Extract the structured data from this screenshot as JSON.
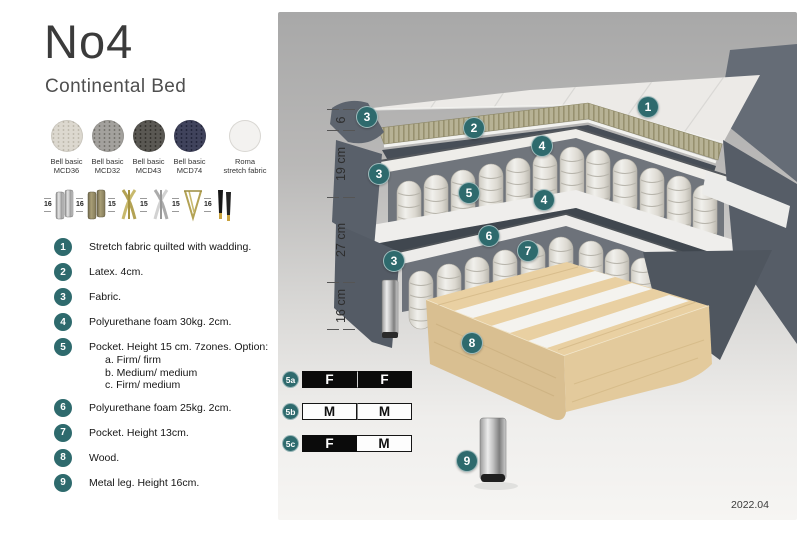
{
  "header": {
    "title": "No4",
    "subtitle": "Continental Bed"
  },
  "fabrics": [
    {
      "line1": "Bell basic",
      "line2": "MCD36"
    },
    {
      "line1": "Bell basic",
      "line2": "MCD32"
    },
    {
      "line1": "Bell basic",
      "line2": "MCD43"
    },
    {
      "line1": "Bell basic",
      "line2": "MCD74"
    },
    {
      "line1": "Roma",
      "line2": "stretch fabric"
    }
  ],
  "leg_options": [
    {
      "height": "16",
      "type": "cylinder-silver"
    },
    {
      "height": "16",
      "type": "cylinder-brass"
    },
    {
      "height": "15",
      "type": "cross-gold"
    },
    {
      "height": "15",
      "type": "cross-silver"
    },
    {
      "height": "15",
      "type": "hairpin-gold"
    },
    {
      "height": "16",
      "type": "tapered-black-gold"
    }
  ],
  "parts": [
    {
      "num": "1",
      "text": "Stretch fabric quilted with wadding."
    },
    {
      "num": "2",
      "text": "Latex. 4cm."
    },
    {
      "num": "3",
      "text": "Fabric."
    },
    {
      "num": "4",
      "text": "Polyurethane foam 30kg. 2cm."
    },
    {
      "num": "5",
      "text": "Pocket. Height 15 cm. 7zones. Option:",
      "options": [
        "a. Firm/ firm",
        "b. Medium/ medium",
        "c. Firm/ medium"
      ]
    },
    {
      "num": "6",
      "text": "Polyurethane foam 25kg. 2cm."
    },
    {
      "num": "7",
      "text": "Pocket. Height 13cm."
    },
    {
      "num": "8",
      "text": "Wood."
    },
    {
      "num": "9",
      "text": "Metal leg. Height 16cm."
    }
  ],
  "diagram": {
    "callouts": [
      {
        "label": "1"
      },
      {
        "label": "2"
      },
      {
        "label": "3"
      },
      {
        "label": "4"
      },
      {
        "label": "3"
      },
      {
        "label": "5"
      },
      {
        "label": "4"
      },
      {
        "label": "6"
      },
      {
        "label": "7"
      },
      {
        "label": "3"
      },
      {
        "label": "8"
      },
      {
        "label": "9"
      }
    ],
    "dimensions": [
      {
        "label": "6"
      },
      {
        "label": "19 cm"
      },
      {
        "label": "27 cm"
      },
      {
        "label": "16 cm"
      }
    ],
    "firmness": [
      {
        "id": "5a",
        "cells": [
          {
            "letter": "F"
          },
          {
            "letter": "F"
          }
        ]
      },
      {
        "id": "5b",
        "cells": [
          {
            "letter": "M"
          },
          {
            "letter": "M"
          }
        ]
      },
      {
        "id": "5c",
        "cells": [
          {
            "letter": "F"
          },
          {
            "letter": "M"
          }
        ]
      }
    ],
    "version": "2022.04"
  },
  "colors": {
    "accent_teal": "#2e6a6d",
    "fabric_dark": "#59606a",
    "latex_olive": "#b7b295",
    "wood": "#e9d0a2",
    "panel_top": "#a8a8a8",
    "panel_bottom": "#f6f5f3"
  }
}
